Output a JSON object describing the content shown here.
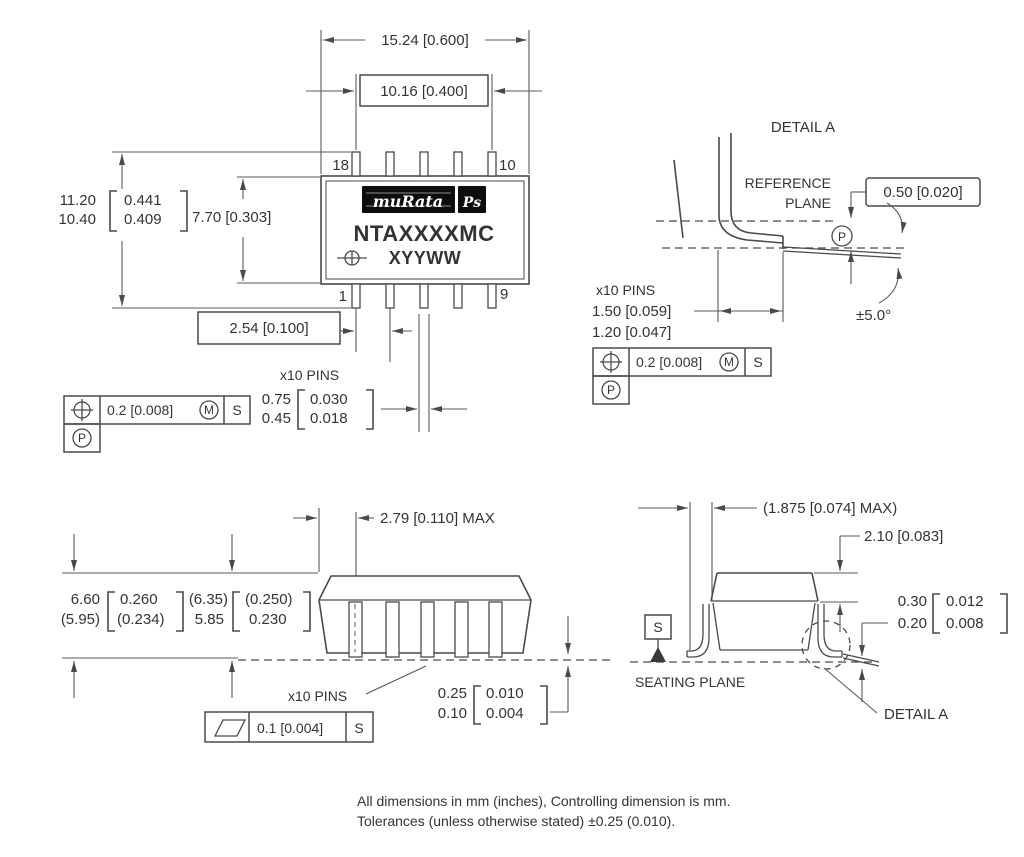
{
  "colors": {
    "line": "#4a4a4a",
    "text": "#333333",
    "logo_bg": "#0d0d0d"
  },
  "top_view": {
    "dim_overall_width": "15.24 [0.600]",
    "dim_pin_span": "10.16 [0.400]",
    "dim_height_mm_max": "11.20",
    "dim_height_mm_min": "10.40",
    "dim_height_in_max": "0.441",
    "dim_height_in_min": "0.409",
    "dim_body_height": "7.70 [0.303]",
    "dim_pin_pitch": "2.54 [0.100]",
    "pins_label": "x10 PINS",
    "pin_width_mm_max": "0.75",
    "pin_width_mm_min": "0.45",
    "pin_width_in_max": "0.030",
    "pin_width_in_min": "0.018",
    "pin_top_left": "18",
    "pin_top_right": "10",
    "pin_bottom_left": "1",
    "pin_bottom_right": "9",
    "logo_main": "muRata",
    "logo_suffix": "Ps",
    "part_number": "NTAXXXXMC",
    "marking_code": "XYYWW",
    "fcf_position": {
      "tolerance": "0.2 [0.008]",
      "modifier": "M",
      "datum": "S",
      "projected": "P"
    }
  },
  "detail_a": {
    "title": "DETAIL A",
    "reference_plane_line1": "REFERENCE",
    "reference_plane_line2": "PLANE",
    "dim_plane_offset": "0.50 [0.020]",
    "projected_datum": "P",
    "angle_tolerance": "±5.0°",
    "pins_label": "x10 PINS",
    "dim_foot_max": "1.50 [0.059]",
    "dim_foot_min": "1.20 [0.047]",
    "fcf_position": {
      "tolerance": "0.2 [0.008]",
      "modifier": "M",
      "datum": "S",
      "projected": "P"
    }
  },
  "front_view": {
    "dim_edge_to_pin": "2.79 [0.110] MAX",
    "dim_total_mm_max": "6.60",
    "dim_total_mm_min": "(5.95)",
    "dim_total_in_max": "0.260",
    "dim_total_in_min": "(0.234)",
    "dim_body_mm_max": "(6.35)",
    "dim_body_mm_min": "5.85",
    "dim_body_in_max": "(0.250)",
    "dim_body_in_min": "0.230",
    "pins_label": "x10 PINS",
    "dim_standoff_mm_max": "0.25",
    "dim_standoff_mm_min": "0.10",
    "dim_standoff_in_max": "0.010",
    "dim_standoff_in_min": "0.004",
    "fcf_flatness": {
      "tolerance": "0.1 [0.004]",
      "datum": "S"
    }
  },
  "side_view": {
    "dim_lead_projection": "(1.875 [0.074] MAX)",
    "dim_cap_height": "2.10 [0.083]",
    "dim_lead_thick_mm_max": "0.30",
    "dim_lead_thick_mm_min": "0.20",
    "dim_lead_thick_in_max": "0.012",
    "dim_lead_thick_in_min": "0.008",
    "datum_s": "S",
    "seating_plane_label": "SEATING PLANE",
    "detail_a_ref": "DETAIL A"
  },
  "notes": {
    "line1": "All dimensions in mm (inches), Controlling dimension is mm.",
    "line2": "Tolerances (unless otherwise stated) ±0.25 (0.010)."
  }
}
